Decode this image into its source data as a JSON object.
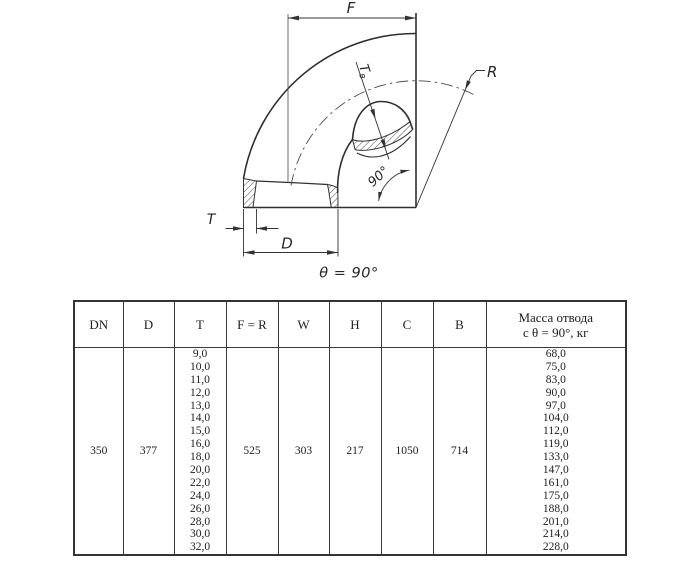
{
  "diagram": {
    "labels": {
      "f": "F",
      "t": "T",
      "d": "D",
      "r": "R",
      "t_wall_main": "T",
      "t_wall_sub": "в",
      "angle": "90°",
      "caption": "θ = 90°"
    },
    "line_color": "#333333",
    "background": "#ffffff"
  },
  "table": {
    "columns": [
      "DN",
      "D",
      "T",
      "F = R",
      "W",
      "H",
      "C",
      "B",
      "Масса отвода\nс θ =  90°, кг"
    ],
    "row": {
      "dn": "350",
      "d": "377",
      "t_values": [
        "9,0",
        "10,0",
        "11,0",
        "12,0",
        "13,0",
        "14,0",
        "15,0",
        "16,0",
        "18,0",
        "20,0",
        "22,0",
        "24,0",
        "26,0",
        "28,0",
        "30,0",
        "32,0"
      ],
      "f_r": "525",
      "w": "303",
      "h": "217",
      "c": "1050",
      "b": "714",
      "mass_values": [
        "68,0",
        "75,0",
        "83,0",
        "90,0",
        "97,0",
        "104,0",
        "112,0",
        "119,0",
        "133,0",
        "147,0",
        "161,0",
        "175,0",
        "188,0",
        "201,0",
        "214,0",
        "228,0"
      ]
    }
  }
}
